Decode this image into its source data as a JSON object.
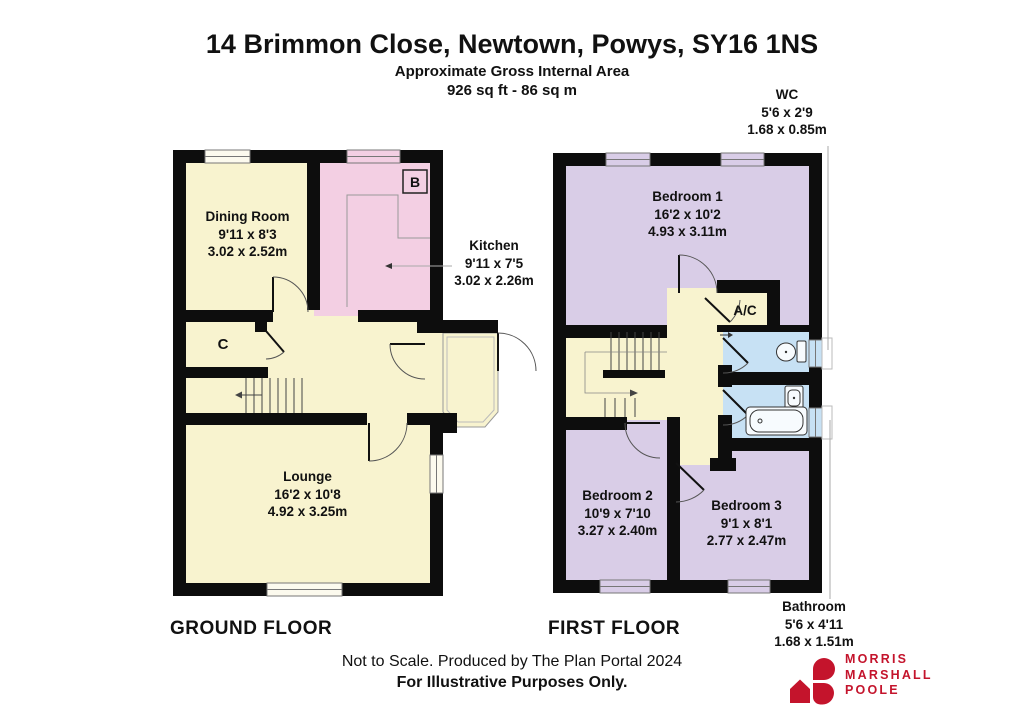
{
  "header": {
    "title": "14 Brimmon Close, Newtown, Powys, SY16 1NS",
    "subtitle_line1": "Approximate Gross Internal Area",
    "subtitle_line2": "926 sq ft - 86 sq m"
  },
  "ground_floor": {
    "label": "GROUND FLOOR",
    "rooms": [
      {
        "name": "Dining Room",
        "imperial": "9'11 x 8'3",
        "metric": "3.02 x 2.52m"
      },
      {
        "name": "Kitchen",
        "imperial": "9'11 x 7'5",
        "metric": "3.02 x 2.26m"
      },
      {
        "name": "Lounge",
        "imperial": "16'2 x 10'8",
        "metric": "4.92 x 3.25m"
      }
    ],
    "markers": {
      "boiler": "B",
      "cupboard": "C"
    }
  },
  "first_floor": {
    "label": "FIRST FLOOR",
    "rooms": [
      {
        "name": "Bedroom 1",
        "imperial": "16'2 x 10'2",
        "metric": "4.93 x 3.11m"
      },
      {
        "name": "Bedroom 2",
        "imperial": "10'9 x 7'10",
        "metric": "3.27 x 2.40m"
      },
      {
        "name": "Bedroom 3",
        "imperial": "9'1 x 8'1",
        "metric": "2.77 x 2.47m"
      },
      {
        "name": "WC",
        "imperial": "5'6 x 2'9",
        "metric": "1.68 x 0.85m"
      },
      {
        "name": "Bathroom",
        "imperial": "5'6 x 4'11",
        "metric": "1.68 x 1.51m"
      }
    ],
    "markers": {
      "airing_cupboard": "A/C"
    }
  },
  "footer": {
    "line1": "Not to Scale. Produced by The Plan Portal 2024",
    "line2": "For Illustrative Purposes Only."
  },
  "logo": {
    "line1": "MORRIS",
    "line2": "MARSHALL",
    "line3": "POOLE"
  },
  "colors": {
    "wall": "#0d0d0d",
    "room_cream": "#F8F3CF",
    "room_pink": "#F3CFE3",
    "room_lavender": "#D9CDE7",
    "room_blue": "#C7E1F4",
    "logo_red": "#C4142C"
  }
}
